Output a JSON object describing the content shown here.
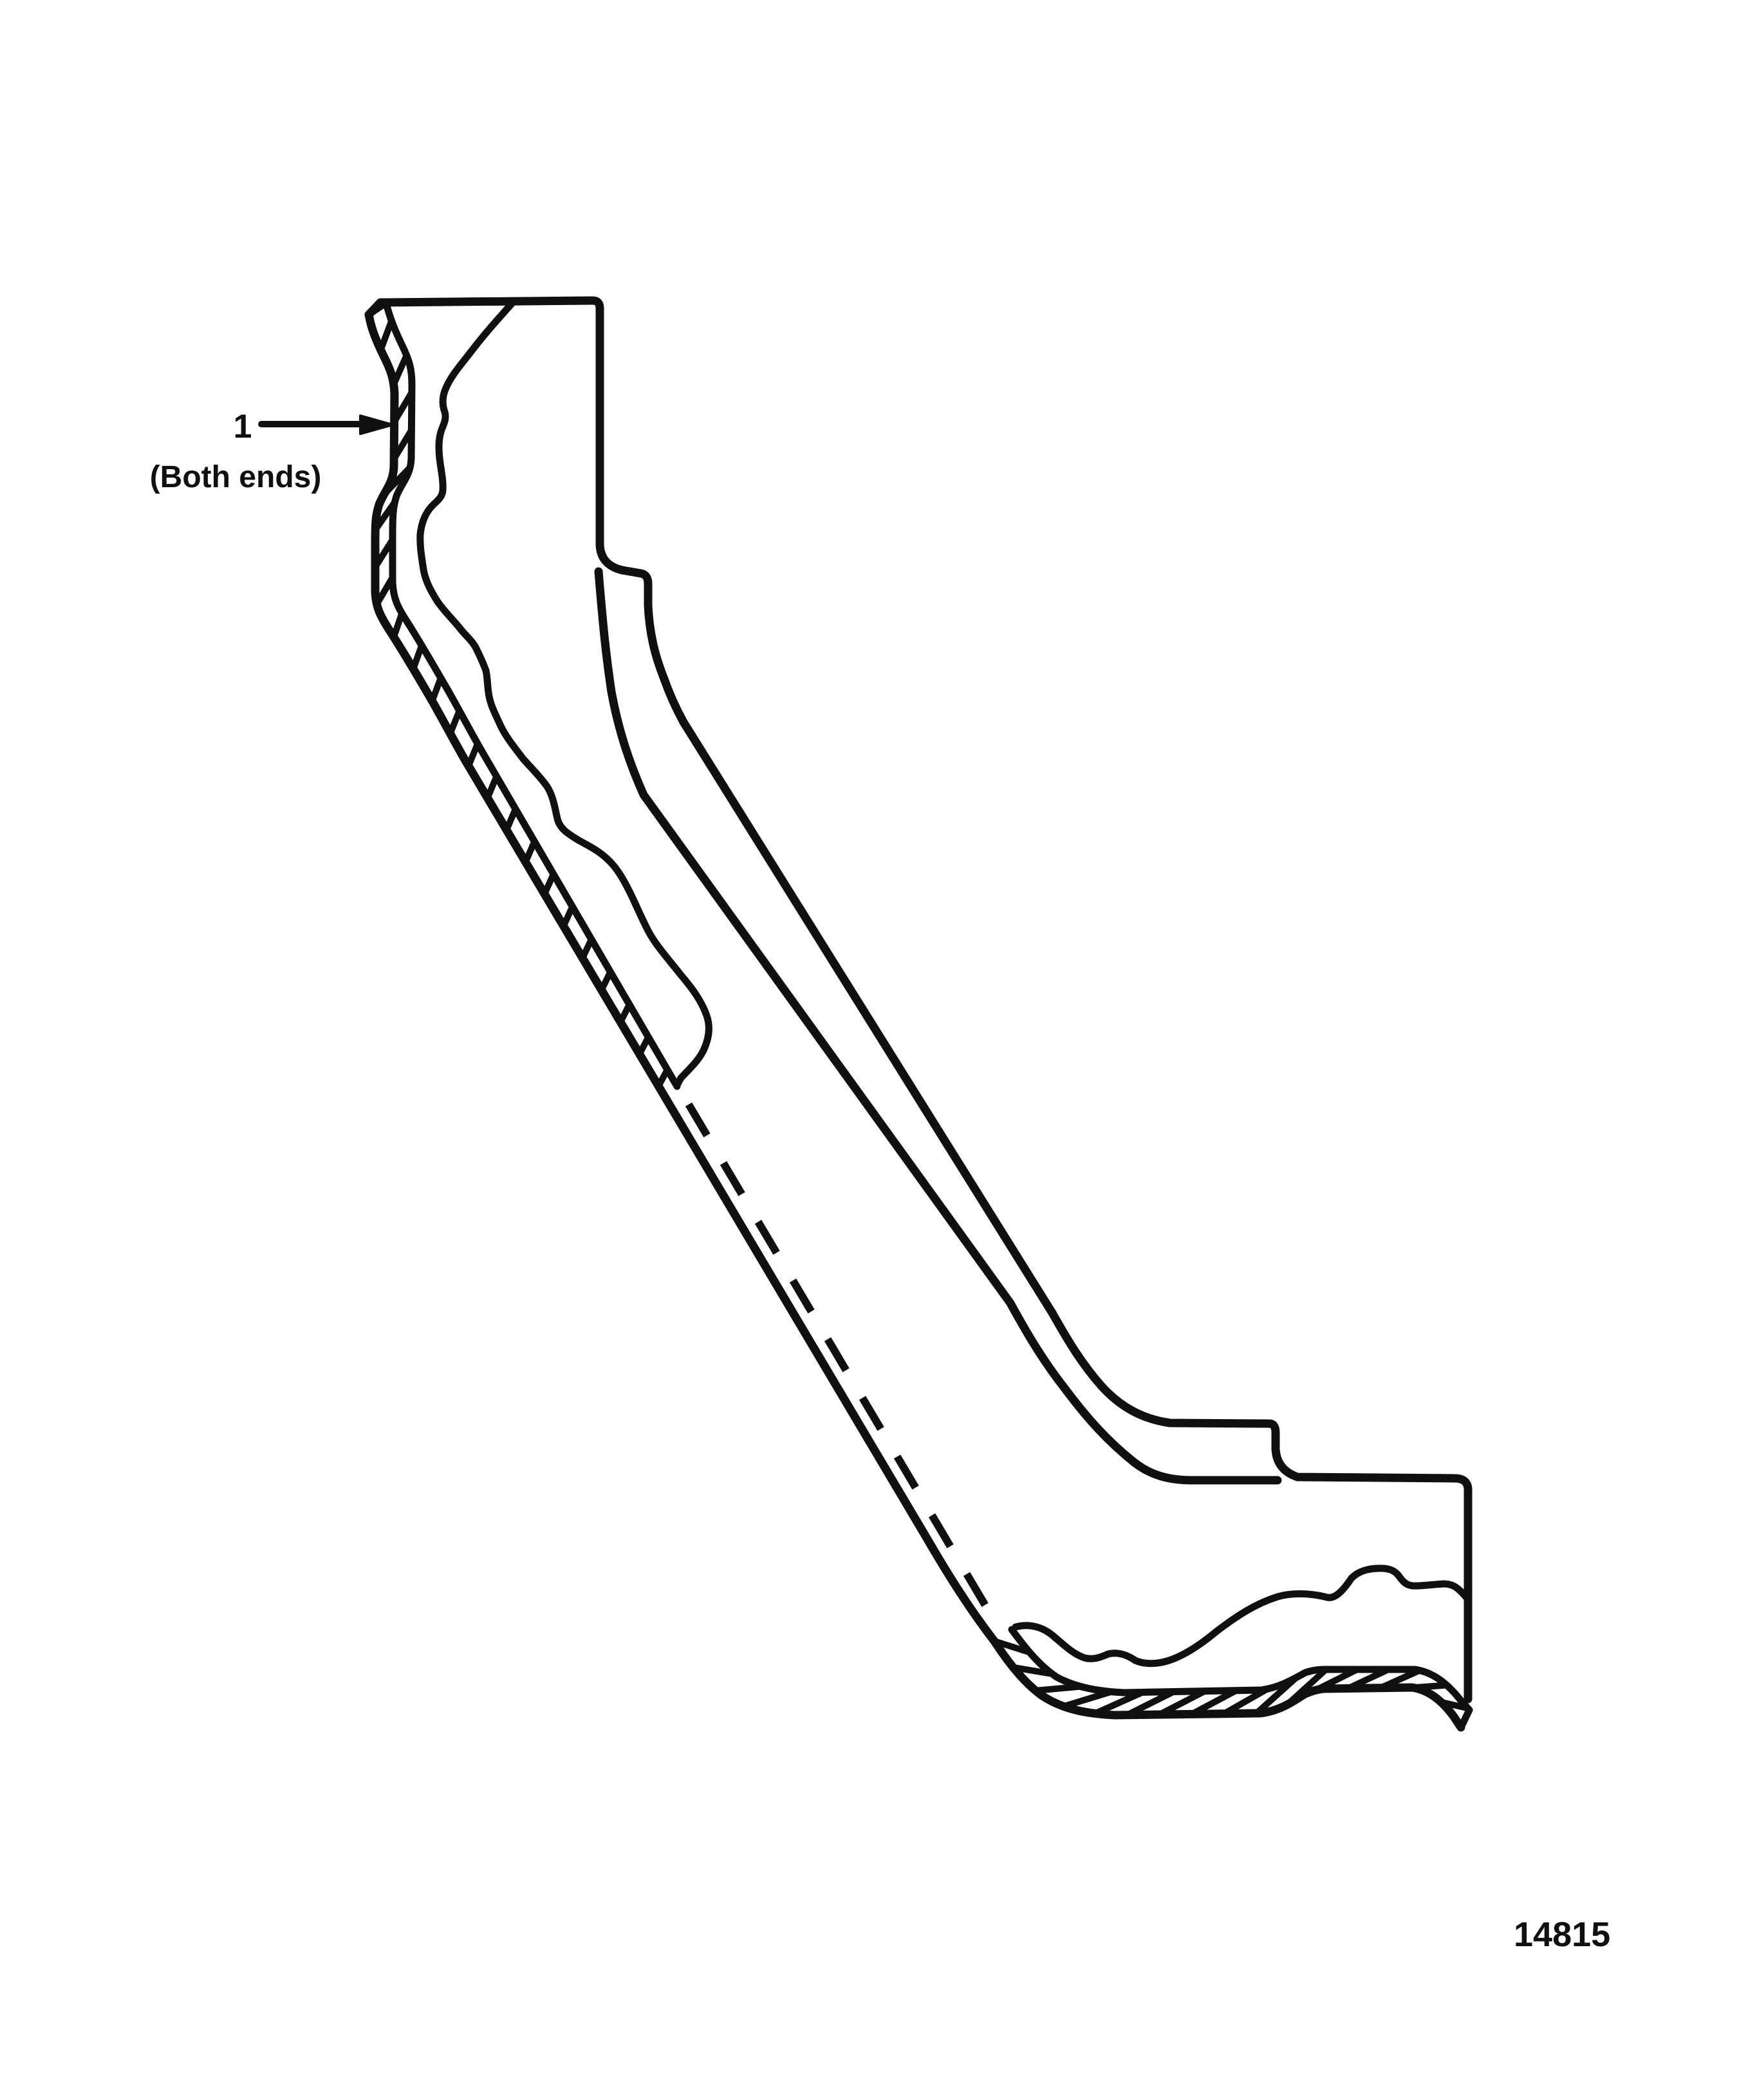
{
  "figure": {
    "callout": {
      "number": "1",
      "note": "(Both ends)"
    },
    "figure_number": "14815",
    "colors": {
      "ink": "#101010",
      "paper": "#ffffff"
    }
  }
}
